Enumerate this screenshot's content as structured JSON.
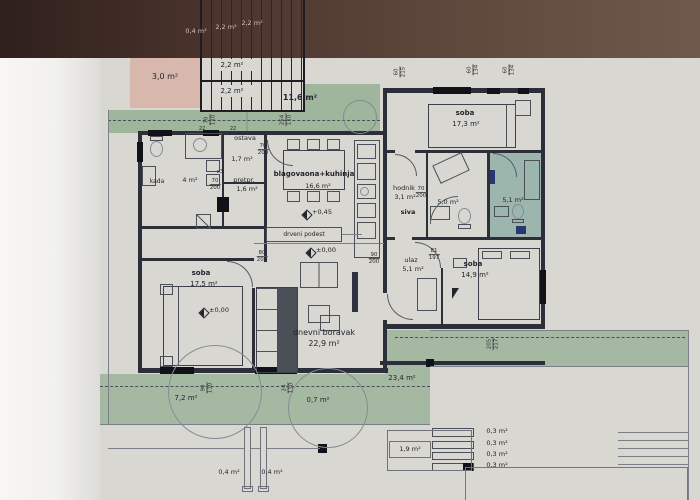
{
  "colors": {
    "paper": "#d8d7d2",
    "margin": "#f4f3f0",
    "dark_band": "#4a342d",
    "green": "#8fae8e",
    "pink": "#d8b7ad",
    "teal": "#7fae9f",
    "wall": "#2c2f3a",
    "ink": "#23242a"
  },
  "rooms": {
    "stair_side": {
      "area": "3,0 m²"
    },
    "stair_upper": {
      "area": "2,2 m²"
    },
    "stair_lower": {
      "area": "2,2 m²"
    },
    "loggia": {
      "area": "11,6 m²"
    },
    "soba_ne": {
      "name": "soba",
      "area": "17,3 m²"
    },
    "ostava": {
      "name": "ostava",
      "area": "1,7 m²"
    },
    "pretprostor": {
      "name": "pretpr.",
      "area": "1,6 m²"
    },
    "kupaonica_left": {
      "name": "kada",
      "area": "4 m²"
    },
    "blagovaona": {
      "name": "blagovaona+kuhinja",
      "area": "16,6 m²"
    },
    "hodnik": {
      "name": "hodnik",
      "area": "3,1 m²",
      "sub": "siva"
    },
    "kupaonica_right": {
      "area": "5,0 m²"
    },
    "soba_teal": {
      "area": "5,1 m²"
    },
    "dnevni_boravak": {
      "name": "dnevni boravak",
      "area": "22,9 m²"
    },
    "soba_sw": {
      "name": "soba",
      "area": "17,5 m²"
    },
    "ulaz": {
      "name": "ulaz",
      "area": "5,1 m²"
    },
    "soba_se": {
      "name": "soba",
      "area": "14,9 m²"
    },
    "terasa_sw": {
      "area": "7,2 m²"
    },
    "terasa_s": {
      "area": "0,7 m²"
    },
    "terasa_se": {
      "area": "23,4 m²"
    },
    "spremiste": {
      "area": "1,9 m²"
    },
    "stuba_1": {
      "area": "0,3 m²"
    },
    "stuba_2": {
      "area": "0,3 m²"
    },
    "stuba_3": {
      "area": "0,3 m²"
    },
    "stuba_4": {
      "area": "0,3 m²"
    },
    "stup_a": {
      "area": "0,4 m²"
    },
    "stup_b": {
      "area": "0,4 m²"
    }
  },
  "elevations": {
    "kuhinja": "+0,45",
    "dnevni": "±0,00",
    "soba": "±0,00"
  },
  "annotations": {
    "podest": "drveni podest",
    "band_a": "0,4 m²",
    "band_b": "2,2 m²",
    "band_c": "2,2 m²"
  },
  "dims": {
    "door_ostava": {
      "a": "70",
      "b": "200"
    },
    "door_pretpr": {
      "a": "70",
      "b": "200"
    },
    "door_hodnik": {
      "a": "70",
      "b": "200"
    },
    "door_soba_sw": {
      "a": "80",
      "b": "200"
    },
    "door_dnevni": {
      "a": "90",
      "b": "200"
    },
    "door_ulaz": {
      "a": "81",
      "b": "197"
    },
    "win_1": {
      "a": "60",
      "b": "215"
    },
    "win_2": {
      "a": "60",
      "b": "134"
    },
    "win_3": {
      "a": "60",
      "b": "134"
    },
    "grn_1": {
      "a": "70",
      "b": "110"
    },
    "grn_2": {
      "a": "254",
      "b": "110"
    },
    "ter_1": {
      "a": "90",
      "b": "110"
    },
    "ter_2": {
      "a": "24",
      "b": "110"
    },
    "ter_3": {
      "a": "205",
      "b": "217"
    },
    "wall_a": "22",
    "wall_b": "22",
    "mark_x3": "x3"
  }
}
